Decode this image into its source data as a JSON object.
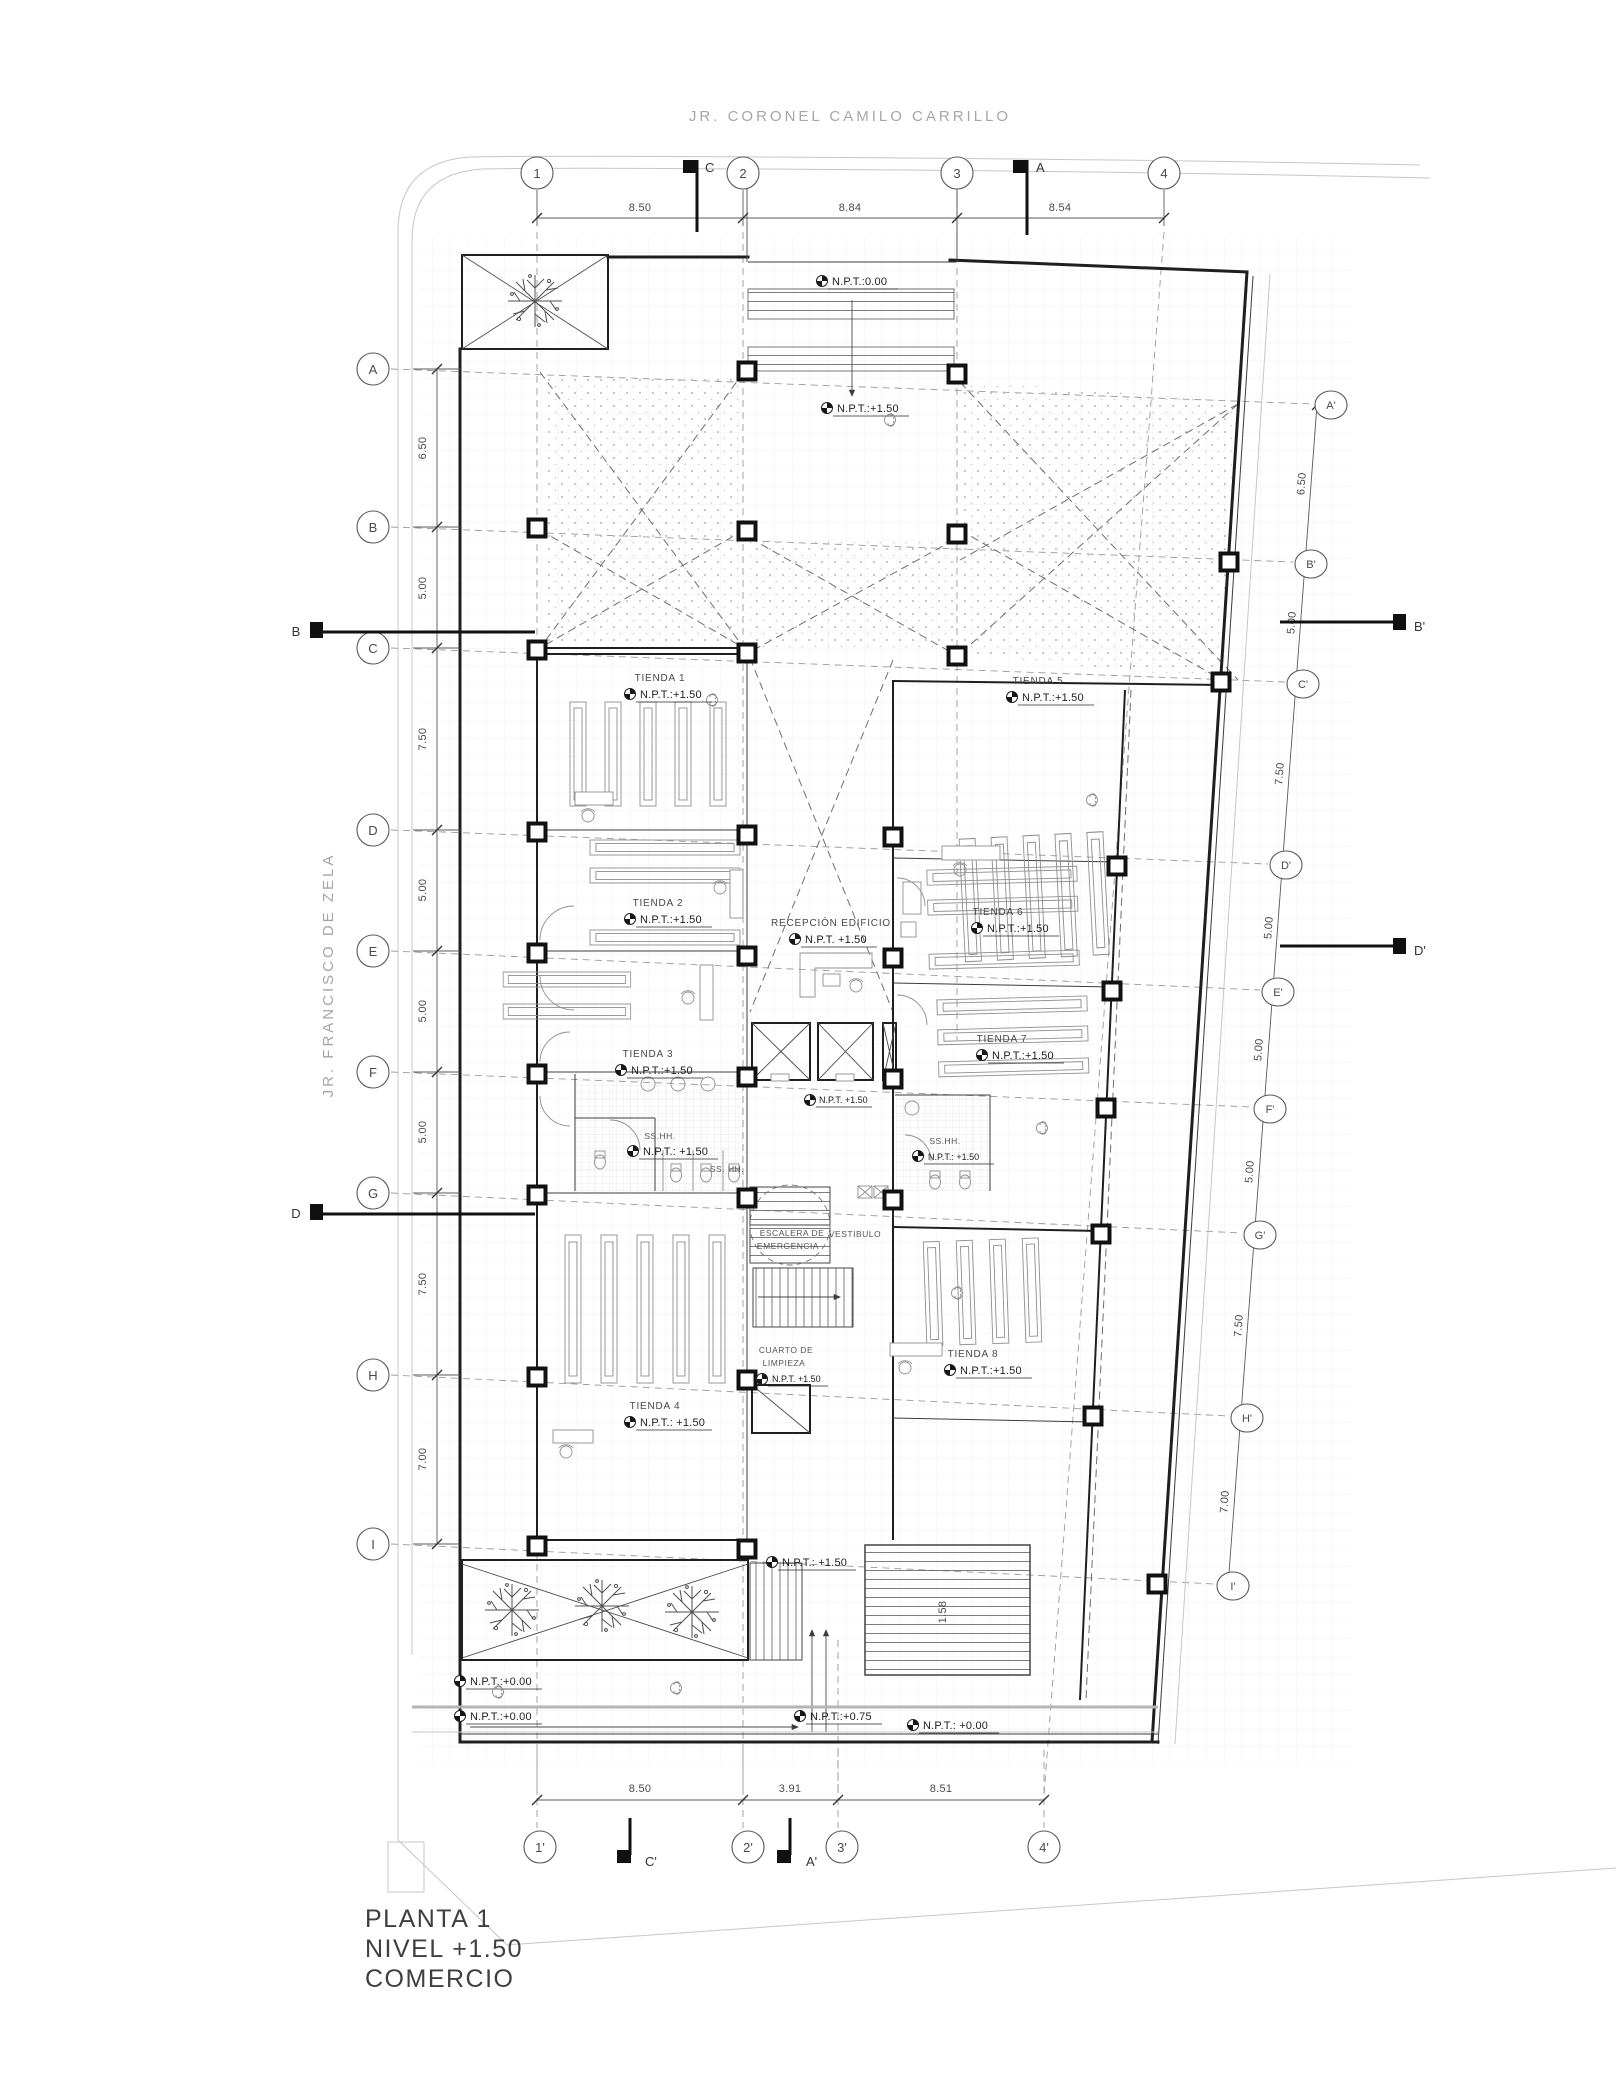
{
  "streets": {
    "top": "JR. CORONEL CAMILO CARRILLO",
    "left": "JR. FRANCISCO DE ZELA"
  },
  "sheet": {
    "title_line1": "PLANTA 1",
    "title_line2": "NIVEL +1.50",
    "title_line3": "COMERCIO"
  },
  "grid": {
    "top": [
      "1",
      "2",
      "3",
      "4"
    ],
    "bottom": [
      "1'",
      "2'",
      "3'",
      "4'"
    ],
    "left": [
      "A",
      "B",
      "C",
      "D",
      "E",
      "F",
      "G",
      "H",
      "I"
    ],
    "right": [
      "A'",
      "B'",
      "C'",
      "D'",
      "E'",
      "F'",
      "G'",
      "H'",
      "I'"
    ]
  },
  "sections": {
    "top": [
      "C",
      "A"
    ],
    "bottom": [
      "C'",
      "A'"
    ],
    "left": [
      "B",
      "D"
    ],
    "right": [
      "B'",
      "D'"
    ]
  },
  "dimensions": {
    "top": [
      "8.50",
      "8.84",
      "8.54"
    ],
    "bottom": [
      "8.50",
      "3.91",
      "8.51"
    ],
    "left": [
      "6.50",
      "5.00",
      "7.50",
      "5.00",
      "5.00",
      "5.00",
      "7.50",
      "7.00"
    ],
    "right": [
      "6.50",
      "5.00",
      "7.50",
      "5.00",
      "5.00",
      "5.00",
      "7.50",
      "7.00"
    ],
    "stair": "1.58"
  },
  "rooms": {
    "tienda1": {
      "name": "TIENDA 1",
      "npt": "N.P.T.:+1.50"
    },
    "tienda2": {
      "name": "TIENDA 2",
      "npt": "N.P.T.:+1.50"
    },
    "tienda3": {
      "name": "TIENDA 3",
      "npt": "N.P.T.:+1.50"
    },
    "tienda4": {
      "name": "TIENDA 4",
      "npt": "N.P.T.: +1.50"
    },
    "tienda5": {
      "name": "TIENDA 5",
      "npt": "N.P.T.:+1.50"
    },
    "tienda6": {
      "name": "TIENDA 6",
      "npt": "N.P.T.:+1.50"
    },
    "tienda7": {
      "name": "TIENDA 7",
      "npt": "N.P.T.:+1.50"
    },
    "tienda8": {
      "name": "TIENDA 8",
      "npt": "N.P.T.:+1.50"
    },
    "recepcion": {
      "name": "RECEPCIÓN EDIFICIO",
      "npt": "N.P.T. +1.50"
    },
    "sshh_left": {
      "name": "SS.HH.",
      "npt": "N.P.T.: +1.50"
    },
    "sshh_left_small": {
      "name": "SS. HH."
    },
    "sshh_right": {
      "name": "SS.HH.",
      "npt": "N.P.T.: +1.50"
    },
    "escalera": {
      "line1": "ESCALERA DE",
      "line2": "EMERGENCIA"
    },
    "vestibulo": {
      "name": "VESTIBULO"
    },
    "cuarto": {
      "line1": "CUARTO DE",
      "line2": "LIMPIEZA",
      "npt": "N.P.T. +1.50"
    }
  },
  "levels": {
    "entry_top": "N.P.T.:0.00",
    "lobby_top": "N.P.T.:+1.50",
    "core_mid": "N.P.T. +1.50",
    "exit_bottom": "N.P.T.: +1.50",
    "sidewalk_a": "N.P.T.:+0.00",
    "sidewalk_b": "N.P.T.:+0.00",
    "ramp": "N.P.T.:+0.75",
    "street_bottom": "N.P.T.: +0.00"
  },
  "colors": {
    "wall": "#1f1f1f",
    "line": "#4a4a4a",
    "furniture": "#8f8f8f",
    "grid": "#e3e3e3",
    "street_text": "#a6a6a6",
    "text": "#3a3a3a",
    "stipple": "#c2c2c2"
  }
}
